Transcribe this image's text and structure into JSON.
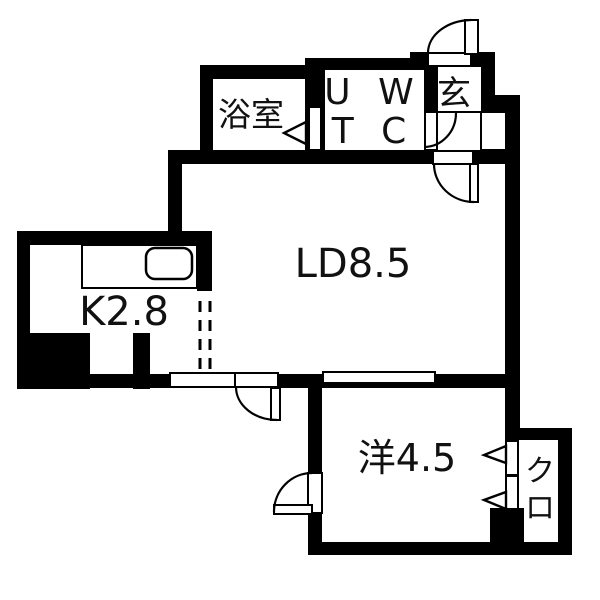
{
  "plan": {
    "type": "japanese-apartment-floor-plan",
    "colors": {
      "wall": "#000000",
      "background": "#ffffff",
      "text": "#111111"
    },
    "rooms": {
      "bathroom": {
        "label": "浴室"
      },
      "ut_wc": {
        "line1": "U W",
        "line2": "T C"
      },
      "entrance": {
        "label": "玄"
      },
      "living_dining": {
        "label": "LD8.5"
      },
      "kitchen": {
        "label": "K2.8"
      },
      "western_room": {
        "label": "洋4.5"
      },
      "closet": {
        "line1": "ク",
        "line2": "ロ"
      }
    }
  }
}
